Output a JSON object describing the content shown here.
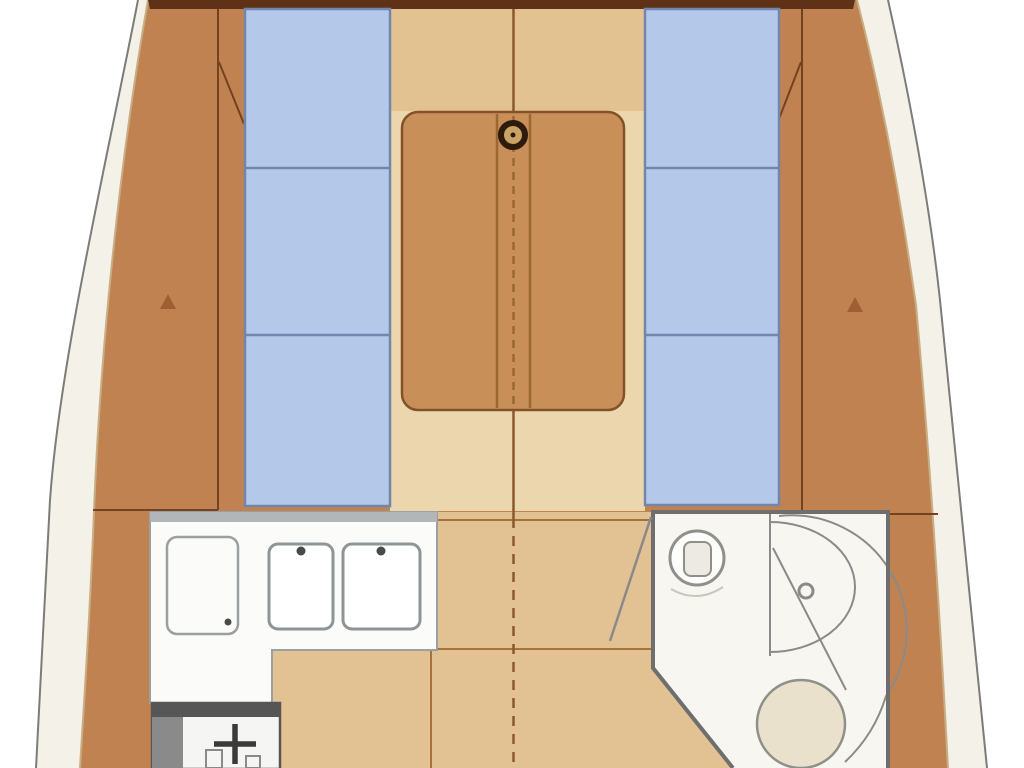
{
  "page": {
    "title": "sailboat-interior-floor-plan",
    "type": "top-down yacht saloon layout, bow at top, companionway aft (cut off at bottom)"
  },
  "colors": {
    "bg": "#ffffff",
    "hull_band": "#f4f2e8",
    "hull_line": "#7c7c78",
    "hull_inner_line": "#c8ae85",
    "bulkhead_dark": "#5f3117",
    "deck_wood": "#c18251",
    "trim_dark": "#74421f",
    "cushion_blue": "#b4c9e9",
    "cushion_line": "#7285ab",
    "floor_light": "#ecd6ad",
    "floor_forward": "#e3c291",
    "floor_aft": "#e2c293",
    "table_wood": "#c88f58",
    "table_outline": "#84522a",
    "table_channel": "#9b6833",
    "seam_brown": "#a5713c",
    "centerline_brown": "#8a5a2e",
    "counter_white": "#fbfbf9",
    "counter_outline": "#9aa0a2",
    "backsplash_gray": "#b2b6b8",
    "sink_outline": "#8f9496",
    "faucet_dark": "#4a4a4a",
    "stove_dark": "#565656",
    "stove_gray": "#8a8a8a",
    "stove_white": "#f5f5f3",
    "burner_dark": "#3a3a3a",
    "head_floor": "#f7f6f1",
    "head_wall": "#6e6e6e",
    "fixture_line": "#90908a",
    "toilet_fill": "#e9e1cb",
    "mast_dark": "#2e1b0c",
    "mast_fill": "#c9a266",
    "mark_brown": "#a05f33"
  },
  "plan": {
    "salon": {
      "port_settee_cushions": 3,
      "starboard_settee_cushions": 3,
      "fixtures": [
        "saloon-table",
        "mast-step",
        "keel-centerline"
      ]
    },
    "galley": {
      "fixtures": [
        "icebox",
        "sink-left",
        "sink-right",
        "stove-burner"
      ]
    },
    "head": {
      "fixtures": [
        "washbasin",
        "shower-stall",
        "shower-door-knob",
        "toilet",
        "head-door"
      ]
    }
  }
}
